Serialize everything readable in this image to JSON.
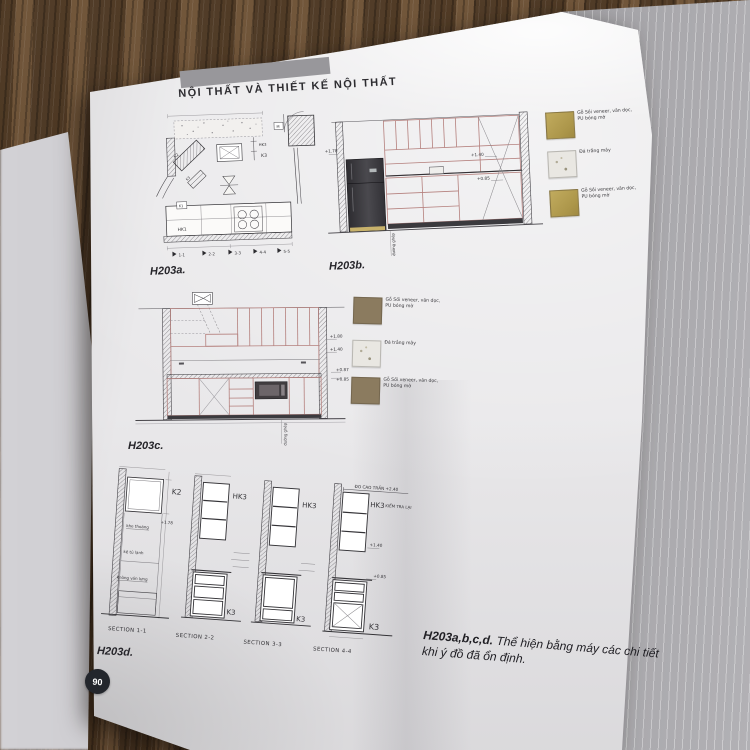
{
  "header": {
    "title": "NỘI THẤT VÀ THIẾT KẾ NỘI THẤT"
  },
  "figures": {
    "a": {
      "label": "H203a.",
      "markers": [
        "1-1",
        "2-2",
        "3-3",
        "4-4",
        "5-5"
      ],
      "tags": {
        "k1": "K1",
        "k2": "K2",
        "k3": "K3",
        "hk1": "HK1",
        "hk3": "HK3",
        "m": "M"
      }
    },
    "b": {
      "label": "H203b.",
      "dim_178": "+1.78",
      "dim_140": "+1.40",
      "dim_085": "+0.85",
      "vertical_note": "đường ghép"
    },
    "c": {
      "label": "H203c.",
      "dim_180": "+1.80",
      "dim_140": "+1.40",
      "dim_087": "+0.87",
      "dim_085": "+0.85",
      "vertical_note": "đường ghép"
    },
    "d": {
      "label": "H203d.",
      "sections": [
        "SECTION 1-1",
        "SECTION 2-2",
        "SECTION 3-3",
        "SECTION 4-4"
      ],
      "tag_k2": "K2",
      "tag_k3": "K3",
      "tag_hk3": "HK3",
      "dim_178": "+1.78",
      "dim_140": "+1.40",
      "dim_085": "+0.85",
      "note_khe_thoang": "khe thoáng",
      "note_ke_tu_lanh": "kệ tủ lạnh",
      "note_khong_van_lung": "không ván lưng",
      "note_do_cao_tran": "ĐO CAO TRẦN +2.40",
      "note_kiem_tra_lai": "KIỂM TRA LẠI"
    }
  },
  "legend": {
    "wood_finish": "Gỗ Sồi veneer, vân dọc, PU bóng mờ",
    "stone_finish": "Đá trắng mây"
  },
  "caption": {
    "bold": "H203a,b,c,d.",
    "text": " Thể hiện bằng máy các chi tiết khi ý đồ đã ổn định."
  },
  "page_number": "90",
  "colors": {
    "cabinet_line": "#b5817e",
    "swatch_gold": "#b29a4e",
    "swatch_brown": "#8b7b5f",
    "page": "#e9e8ea",
    "wood_desk": "#55402c"
  }
}
